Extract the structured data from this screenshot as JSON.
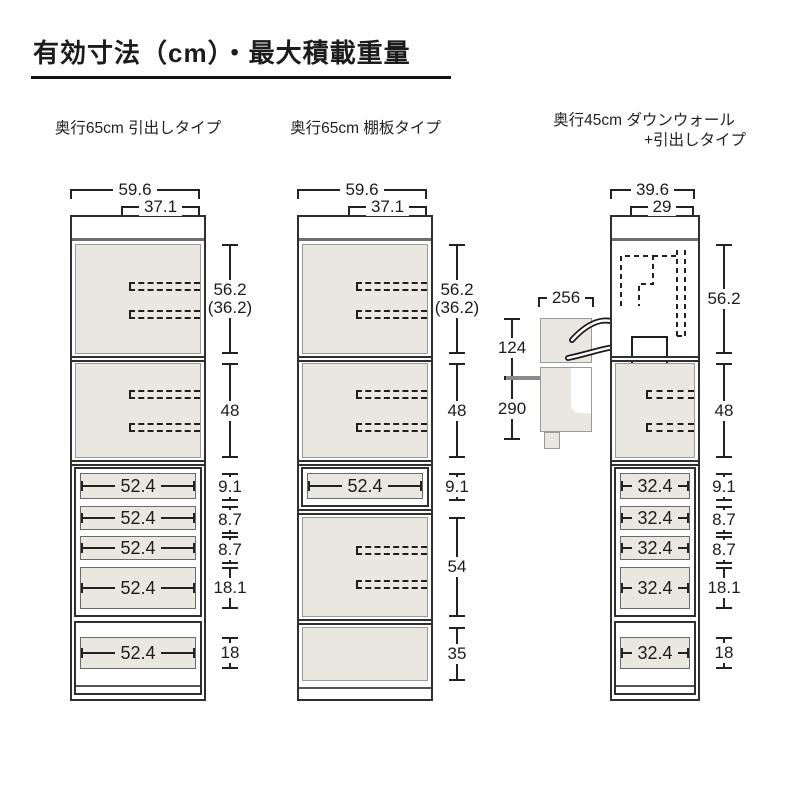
{
  "title": "有効寸法（cm）・最大積載重量",
  "cabinets": [
    {
      "header": "奥行65cm 引出しタイプ",
      "dim_outer_width": "59.6",
      "dim_inner_width": "37.1",
      "dim_upper": "56.2",
      "dim_upper_sub": "(36.2)",
      "dim_shelf": "48",
      "drawers": [
        {
          "label": "52.4",
          "dim": "9.1"
        },
        {
          "label": "52.4",
          "dim": "8.7"
        },
        {
          "label": "52.4",
          "dim": "8.7"
        },
        {
          "label": "52.4",
          "dim": "18.1"
        }
      ],
      "base_drawer": {
        "label": "52.4",
        "dim": "18"
      }
    },
    {
      "header": "奥行65cm 棚板タイプ",
      "dim_outer_width": "59.6",
      "dim_inner_width": "37.1",
      "dim_upper": "56.2",
      "dim_upper_sub": "(36.2)",
      "dim_shelf": "48",
      "drawer": {
        "label": "52.4",
        "dim": "9.1"
      },
      "dim_lower_shelf": "54",
      "dim_base": "35"
    },
    {
      "header": "奥行45cm ダウンウォール",
      "header_line2": "+引出しタイプ",
      "dim_outer_width": "39.6",
      "dim_inner_width": "29",
      "dim_upper": "56.2",
      "dim_shelf": "48",
      "drawers": [
        {
          "label": "32.4",
          "dim": "9.1"
        },
        {
          "label": "32.4",
          "dim": "8.7"
        },
        {
          "label": "32.4",
          "dim": "8.7"
        },
        {
          "label": "32.4",
          "dim": "18.1"
        }
      ],
      "base_drawer": {
        "label": "32.4",
        "dim": "18"
      }
    }
  ],
  "inset": {
    "dim_width": "256",
    "dim_upper": "124",
    "dim_lower": "290"
  },
  "colors": {
    "fill": "#eae7e1",
    "line": "#2b2b2b"
  }
}
